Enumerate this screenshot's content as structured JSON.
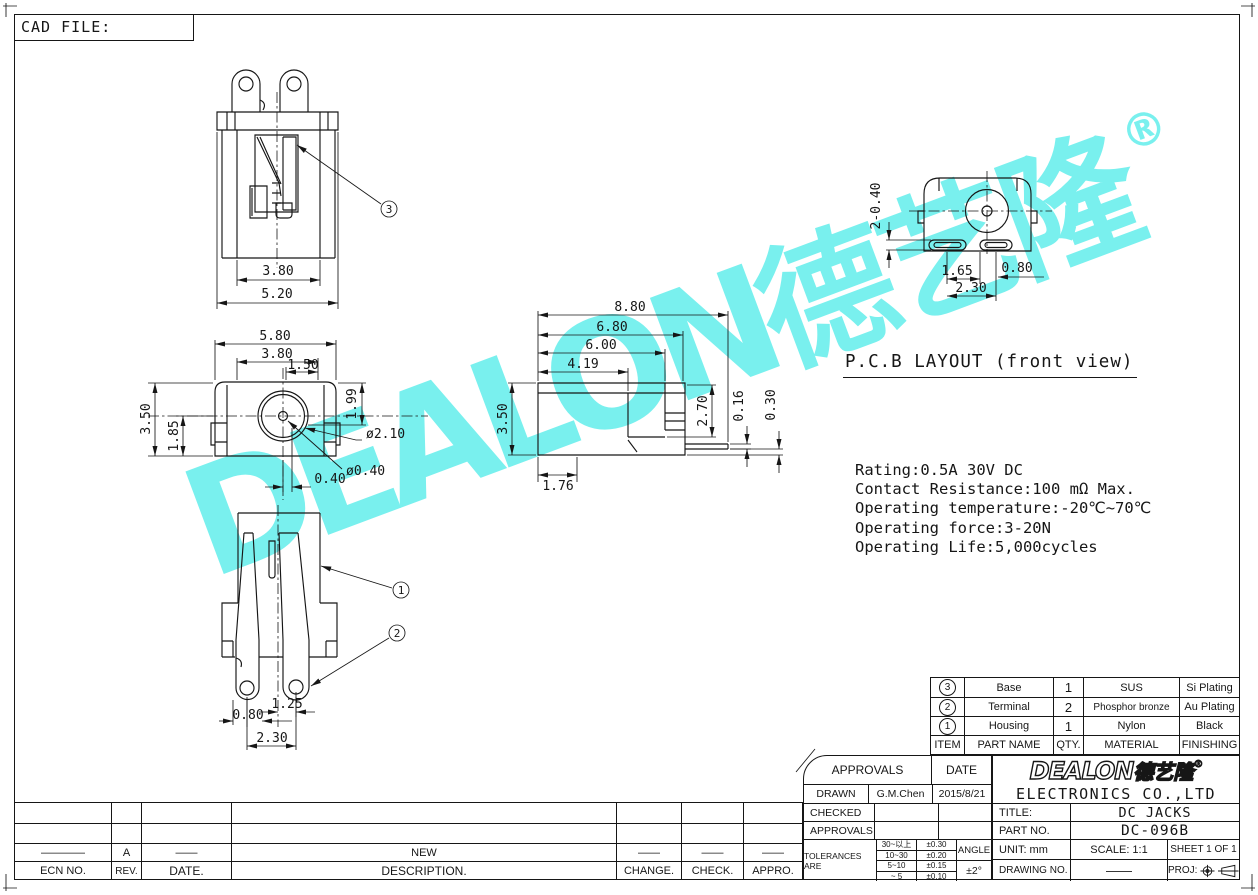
{
  "sheet": {
    "cad_file_label": "CAD FILE:"
  },
  "watermark": {
    "text": "DEALON",
    "cjk": "德艺隆",
    "reg": "®",
    "color": "#74f0ee"
  },
  "pcb_layout": {
    "title": "P.C.B LAYOUT (front view)"
  },
  "specs": {
    "lines": [
      "Rating:0.5A 30V DC",
      "Contact Resistance:100 mΩ Max.",
      "Operating temperature:-20℃~70℃",
      "Operating force:3-20N",
      "Operating Life:5,000cycles"
    ]
  },
  "views": {
    "top": {
      "dim_inner": "3.80",
      "dim_outer": "5.20",
      "callout": "3"
    },
    "front": {
      "dim_w1": "5.80",
      "dim_w2": "3.80",
      "dim_w3": "1.50",
      "dim_h1": "1.99",
      "dim_h2": "3.50",
      "dim_h3": "1.85",
      "dim_d1": "ø2.10",
      "dim_d2": "ø0.40",
      "dim_off": "0.40"
    },
    "side": {
      "dim_l1": "8.80",
      "dim_l2": "6.80",
      "dim_l3": "6.00",
      "dim_l4": "4.19",
      "dim_h1": "3.50",
      "dim_h2": "2.70",
      "dim_t1": "0.16",
      "dim_t2": "0.30",
      "dim_f": "1.76"
    },
    "bottom": {
      "dim_p1": "1.25",
      "dim_p2": "0.80",
      "dim_pitch": "2.30",
      "callout_1": "1",
      "callout_2": "2"
    },
    "pcb": {
      "dim_slots": "2-0.40",
      "dim_p1": "1.65",
      "dim_pitch": "2.30",
      "dim_p2": "0.80"
    }
  },
  "parts_table": {
    "headers": {
      "item": "ITEM",
      "name": "PART NAME",
      "qty": "QTY.",
      "material": "MATERIAL",
      "finishing": "FINISHING"
    },
    "rows": [
      {
        "item": "3",
        "name": "Base",
        "qty": "1",
        "material": "SUS",
        "finishing": "Si Plating"
      },
      {
        "item": "2",
        "name": "Terminal",
        "qty": "2",
        "material": "Phosphor bronze",
        "finishing": "Au Plating"
      },
      {
        "item": "1",
        "name": "Housing",
        "qty": "1",
        "material": "Nylon",
        "finishing": "Black"
      }
    ]
  },
  "approvals": {
    "header": "APPROVALS",
    "date_header": "DATE",
    "drawn_label": "DRAWN",
    "drawn_name": "G.M.Chen",
    "drawn_date": "2015/8/21",
    "checked_label": "CHECKED",
    "approvals_label": "APPROVALS",
    "tolerances_label": "TOLERANCES ARE",
    "tol_rows": [
      {
        "range": "30~以上",
        "tol": "±0.30"
      },
      {
        "range": "10~30",
        "tol": "±0.20"
      },
      {
        "range": "5~10",
        "tol": "±0.15"
      },
      {
        "range": "~ 5",
        "tol": "±0.10"
      }
    ],
    "angle_label": "ANGLE",
    "angle_value": "±2°"
  },
  "company": {
    "logo": "DEALON",
    "logo_cjk": "德艺隆",
    "reg": "®",
    "name": "ELECTRONICS CO.,LTD"
  },
  "title_block": {
    "title_label": "TITLE:",
    "title_value": "DC JACKS",
    "part_label": "PART NO.",
    "part_value": "DC-096B",
    "unit_label": "UNIT: mm",
    "scale_label": "SCALE: 1:1",
    "sheet_label": "SHEET 1 OF 1",
    "drawing_label": "DRAWING NO.",
    "drawing_value": "——",
    "proj_label": "PROJ:"
  },
  "revision": {
    "headers": {
      "ecn": "ECN NO.",
      "rev": "REV.",
      "date": "DATE.",
      "desc": "DESCRIPTION.",
      "change": "CHANGE.",
      "check": "CHECK.",
      "appro": "APPRO."
    },
    "row": {
      "ecn": "————",
      "rev": "A",
      "date": "——",
      "desc": "NEW",
      "change": "——",
      "check": "——",
      "appro": "——"
    }
  }
}
